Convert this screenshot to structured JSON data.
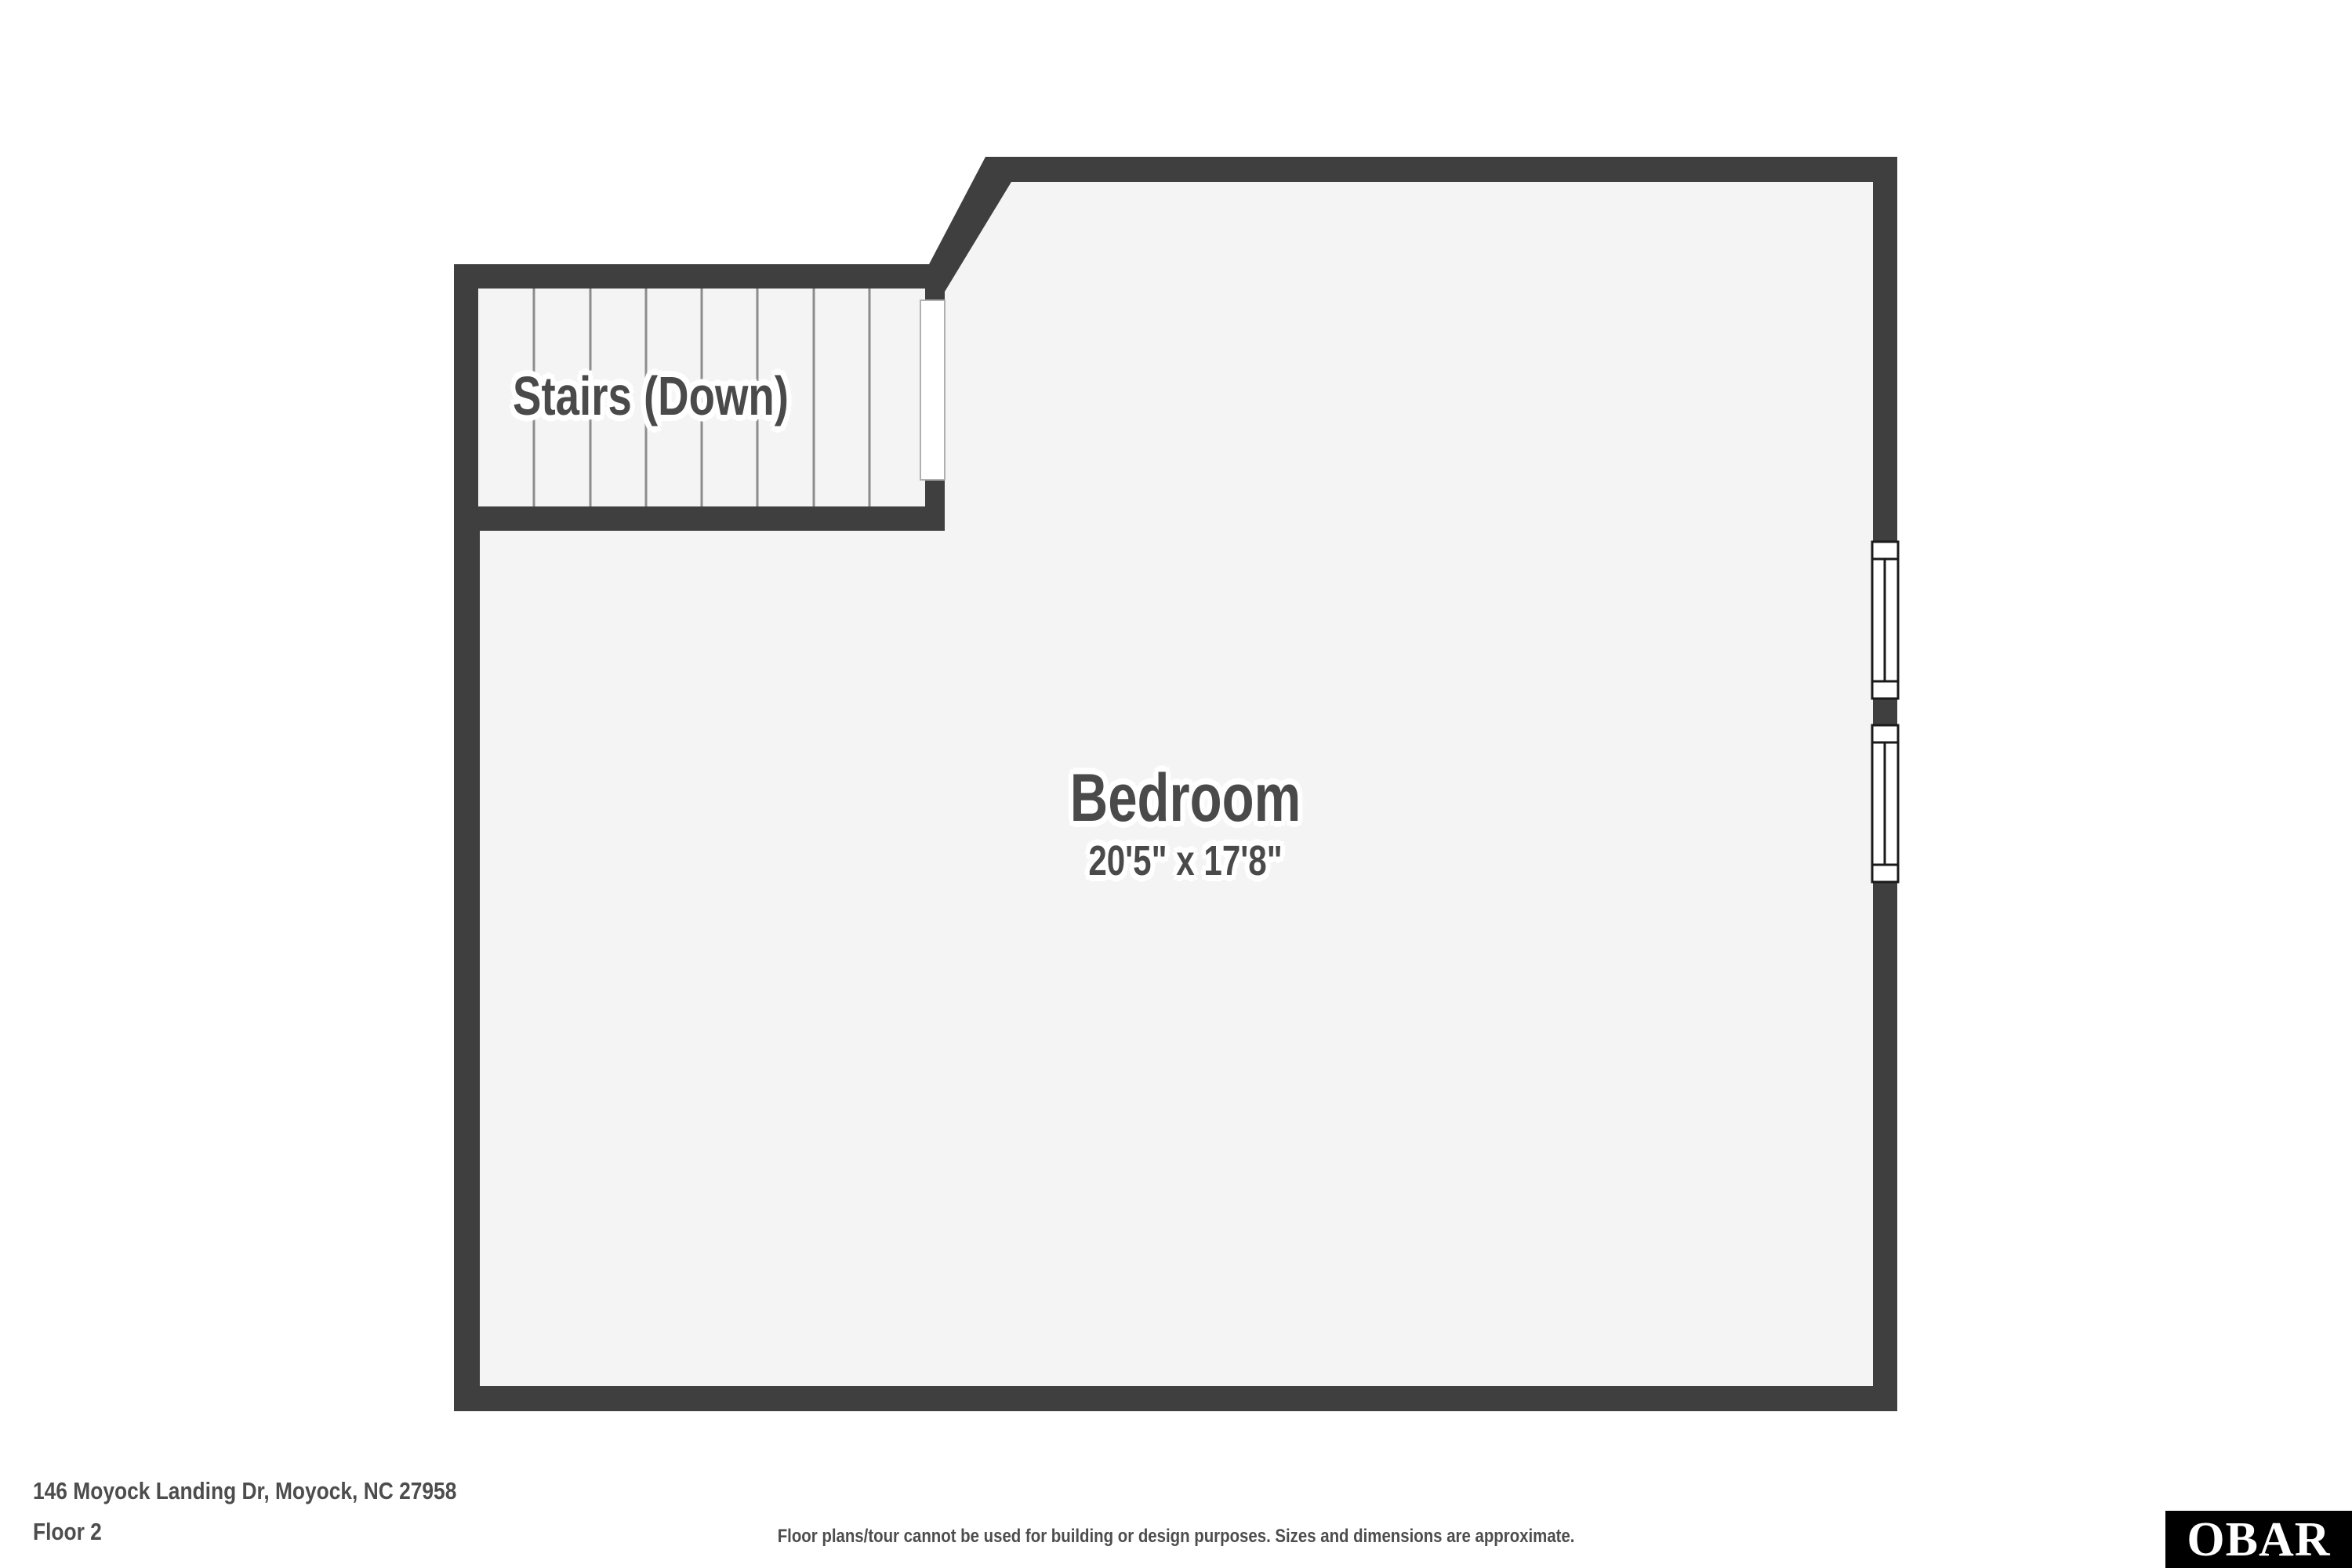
{
  "plan": {
    "stairs": {
      "label": "Stairs (Down)",
      "tread_count": 8
    },
    "room": {
      "name": "Bedroom",
      "dimensions": "20'5\" x 17'8\""
    },
    "window_count": 2,
    "colors": {
      "wall": "#3f3f3f",
      "floor": "#f4f4f4",
      "background": "#ffffff",
      "label_text": "#4a4a4a",
      "stair_tread_line": "#8c8c8c",
      "opening_fill": "#ffffff",
      "opening_edge": "#b0b0b0",
      "window_fill": "#ffffff",
      "window_border": "#1a1a1a"
    }
  },
  "footer": {
    "address": "146 Moyock Landing Dr, Moyock, NC 27958",
    "floor_label": "Floor 2",
    "disclaimer": "Floor plans/tour cannot be used for building or design purposes. Sizes and dimensions are approximate.",
    "text_color": "#4d4d4d",
    "logo_text": "OBAR",
    "logo_bg": "#000000",
    "logo_text_color": "#ffffff"
  }
}
